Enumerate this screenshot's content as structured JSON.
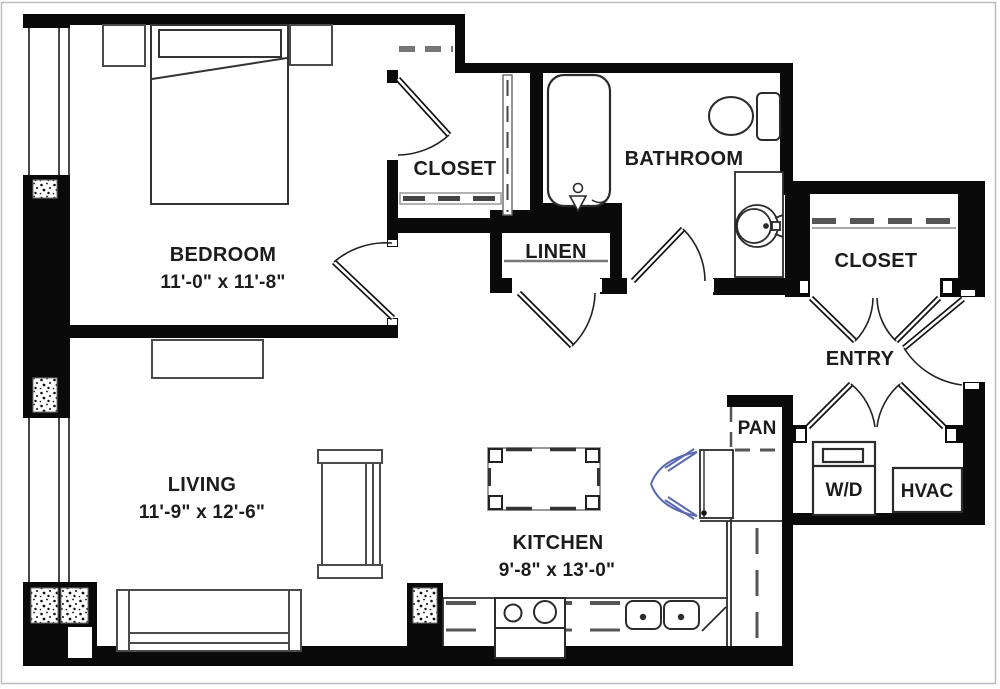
{
  "plan": {
    "type": "apartment-floor-plan",
    "rooms": {
      "bedroom": {
        "label": "BEDROOM",
        "dims": "11'-0\" x 11'-8\""
      },
      "living": {
        "label": "LIVING",
        "dims": "11'-9\" x 12'-6\""
      },
      "kitchen": {
        "label": "KITCHEN",
        "dims": "9'-8\" x 13'-0\""
      },
      "bathroom": {
        "label": "BATHROOM"
      },
      "bedroom_closet": {
        "label": "CLOSET"
      },
      "entry_closet": {
        "label": "CLOSET"
      },
      "linen": {
        "label": "LINEN"
      },
      "entry": {
        "label": "ENTRY"
      },
      "pantry": {
        "label": "PAN"
      },
      "washer_dryer": {
        "label": "W/D"
      },
      "hvac": {
        "label": "HVAC"
      }
    },
    "colors": {
      "wall": "#0a0a0a",
      "line": "#2b2b2b",
      "furniture": "#4a4a4a",
      "shelf": "#8a8a8a",
      "appliance_accent": "#5a6ab0",
      "page_frame": "#b9bec4"
    }
  }
}
